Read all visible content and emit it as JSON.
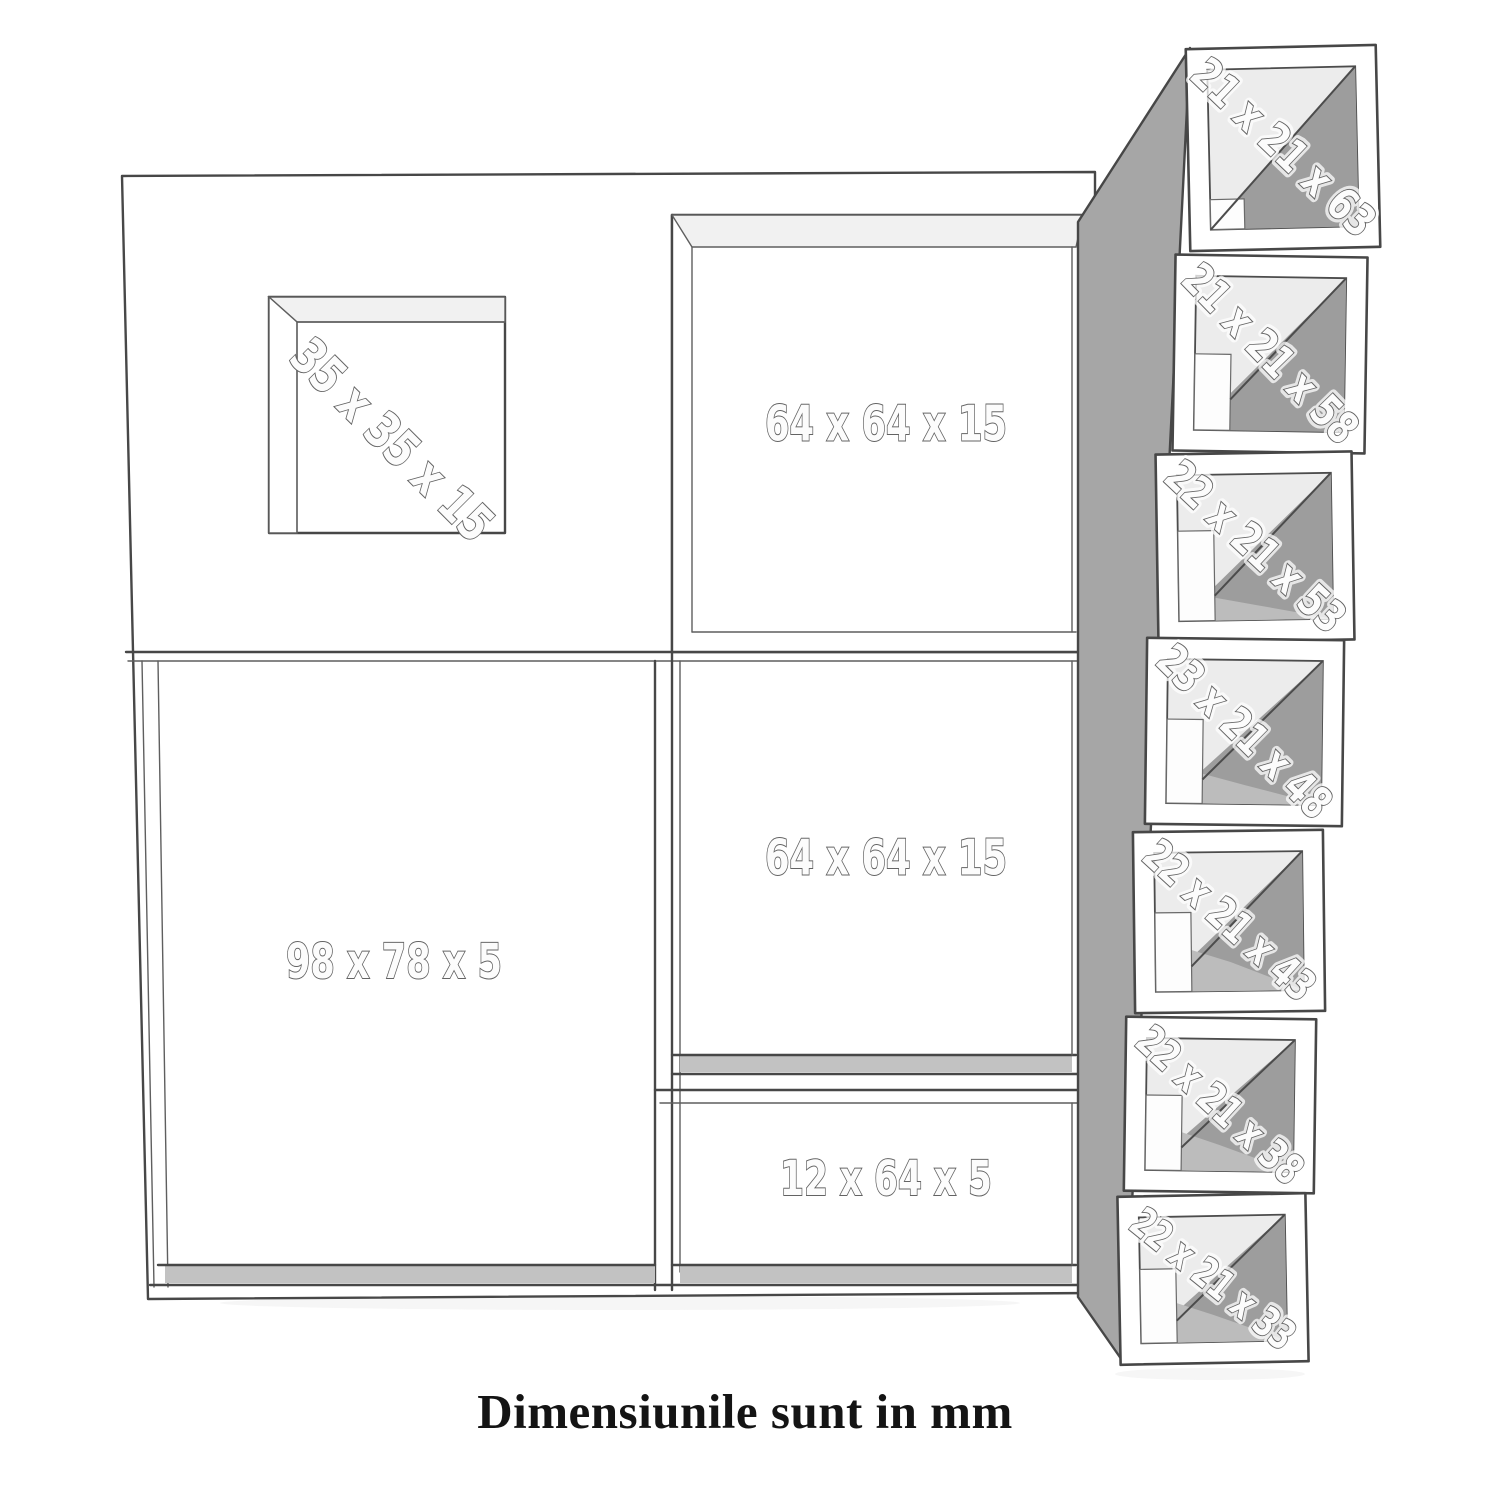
{
  "diagram": {
    "caption": "Dimensiunile sunt in mm",
    "unit_compartments": {
      "niche": "35 x 35 x 15",
      "top_middle": "64 x 64 x 15",
      "middle": "64 x 64 x 15",
      "left_large": "98 x 78 x 5",
      "bottom_wide": "12 x 64 x 5"
    },
    "stacked_boxes": [
      {
        "label": "21 x 21 x 63"
      },
      {
        "label": "21 x 21 x 58"
      },
      {
        "label": "22 x 21 x 53"
      },
      {
        "label": "23 x 21 x 48"
      },
      {
        "label": "22 x 21 x 43"
      },
      {
        "label": "22 x 21 x 38"
      },
      {
        "label": "22 x 21 x 33"
      }
    ],
    "colors": {
      "background": "#ffffff",
      "outline": "#474747",
      "side_panel_gray": "#a6a6a6",
      "interior_shade_dark": "#9d9d9d",
      "interior_shade_light": "#ececec",
      "floor_gray": "#c2c2c2",
      "label_fill": "#fcfcfc",
      "label_outline": "#636363",
      "caption_color": "#141414"
    }
  }
}
